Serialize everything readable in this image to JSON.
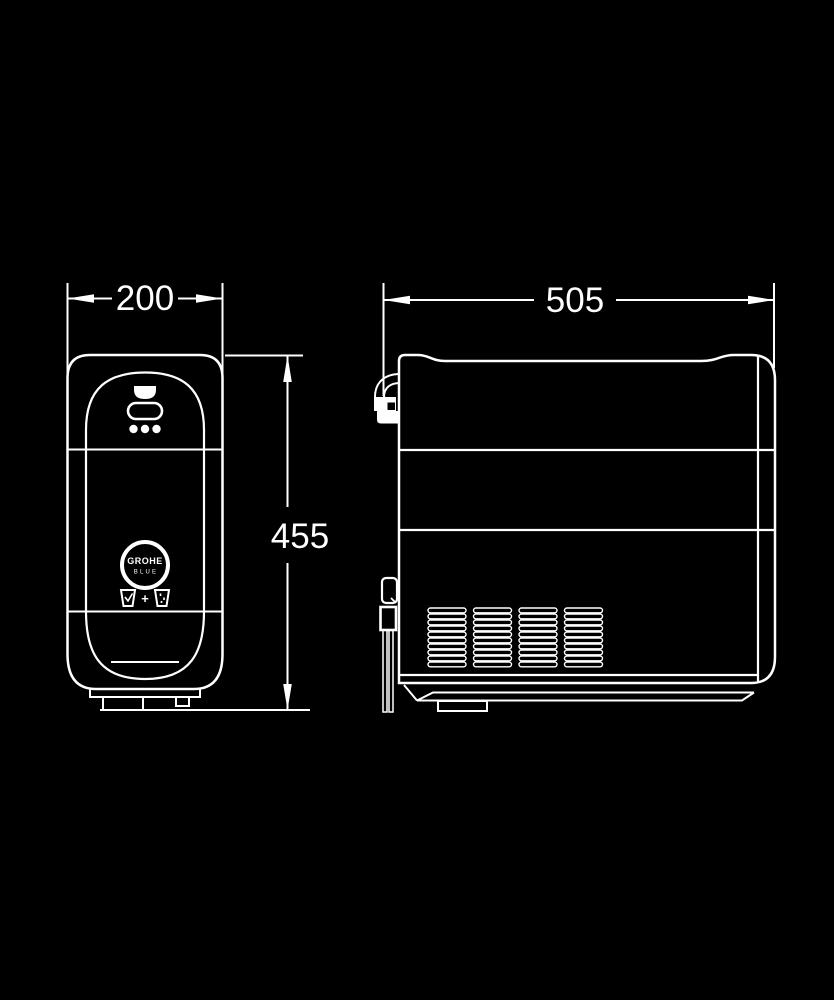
{
  "drawing": {
    "background_color": "#000000",
    "line_color": "#ffffff",
    "dimensions": {
      "front_width_mm": "200",
      "front_height_mm": "455",
      "side_depth_mm": "505"
    },
    "front_view": {
      "logo_text_top": "GROHE",
      "logo_text_bottom": "BLUE",
      "glasses_separator": "+",
      "icons": {
        "outlet": "spout-outlet-icon",
        "display": "display-pill-icon",
        "leds": "led-dots-icon",
        "glasses": "still-and-sparkling-glasses-icon",
        "logo": "grohe-blue-logo"
      }
    },
    "side_view": {
      "vent_grille": {
        "rows": 10,
        "columns": 4
      },
      "icons": {
        "vent": "ventilation-grille-icon",
        "top_connector": "water-hose-connector-icon",
        "bottom_connector": "water-tubes-icon"
      }
    }
  }
}
